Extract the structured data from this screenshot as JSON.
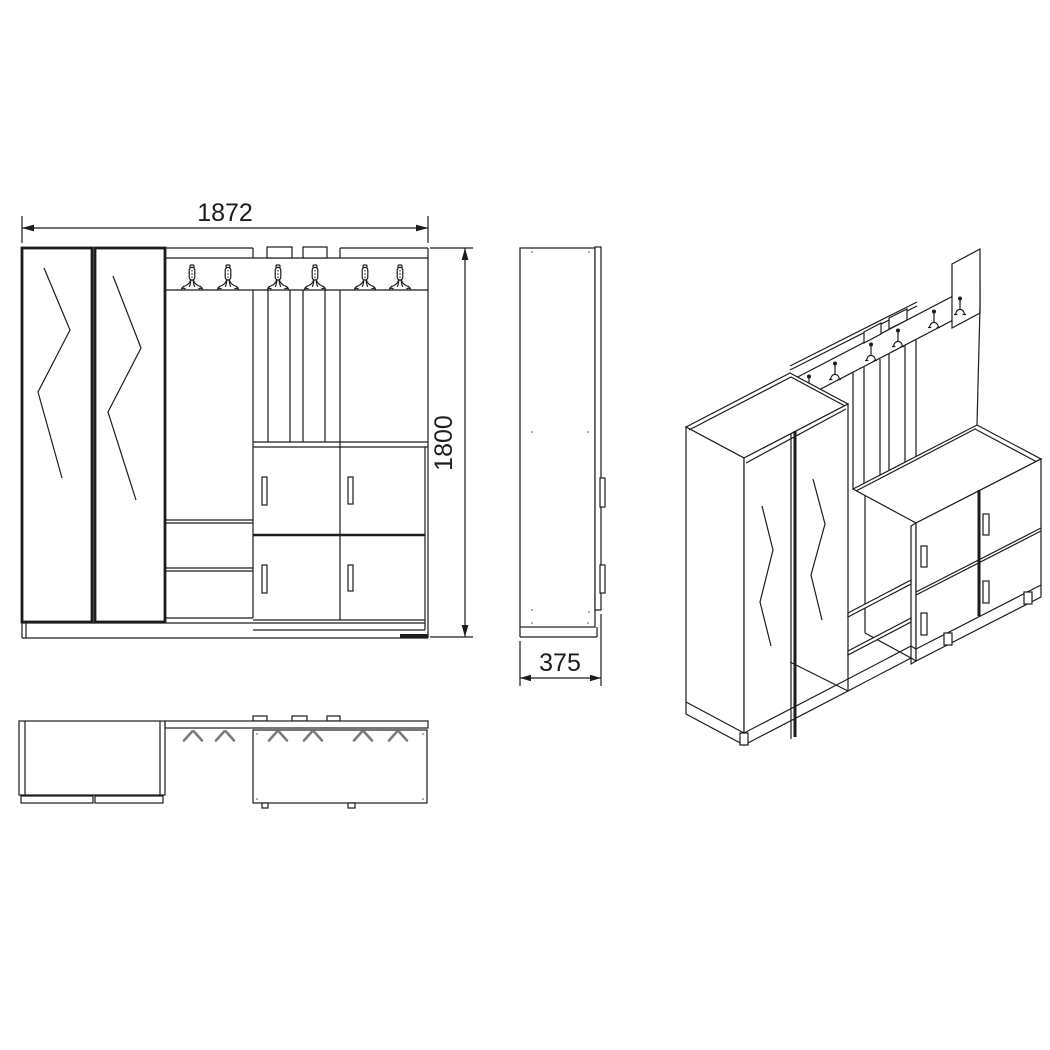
{
  "drawing": {
    "background_color": "#ffffff",
    "line_color": "#1c1c1c",
    "plan_hook_color": "#7b7b7b",
    "dimensions": {
      "width_mm": "1872",
      "height_mm": "1800",
      "depth_mm": "375"
    },
    "front_view": {
      "coat_hook_count": 6,
      "wardrobe_door_count": 2,
      "cabinet_door_count": 4
    },
    "plan_view": {
      "coat_hook_count": 6
    },
    "iso_view": {
      "coat_hook_count": 6
    }
  }
}
